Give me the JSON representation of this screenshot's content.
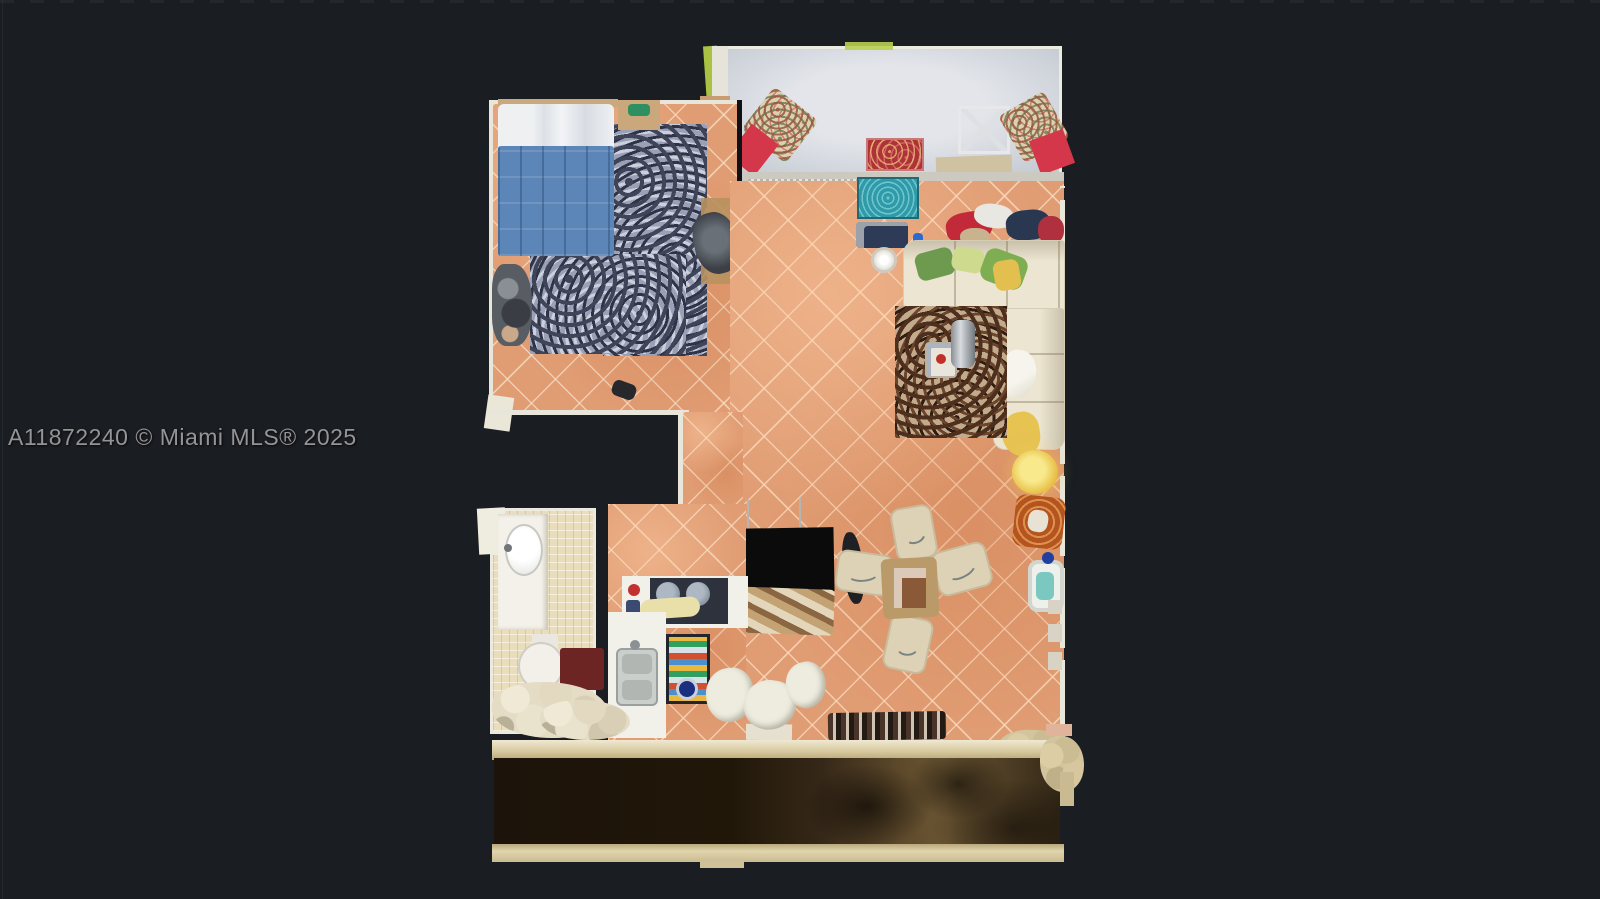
{
  "watermark": {
    "text": "A11872240 © Miami MLS® 2025"
  },
  "scene": {
    "kind": "top-down 3D dollhouse floor-plan scan of an apartment (MLS listing photo)",
    "background_color": "#1a1d22",
    "watermark_color": "#949494",
    "palette": {
      "tile_floor": "#e09c73",
      "bathroom_tile": "#e9ddbb",
      "terrace_floor": "#d9dce1",
      "walkway_floor": "#221809",
      "walls": "#e9e6da",
      "bed_duvet_blue": "#5d86b8",
      "sofa_cream": "#ece5d1",
      "accent_red": "#c22a3a",
      "teal_rug": "#2f9aa8",
      "maroon_mat": "#6c2522",
      "lamp_yellow": "#eccf56"
    },
    "rooms": [
      {
        "name": "terrace",
        "contents": [
          "red lounge chairs with floral cushions",
          "red patterned rug",
          "white metal table",
          "tan bench",
          "green planter accents"
        ]
      },
      {
        "name": "bedroom",
        "contents": [
          "bed with blue duvet and white pillows",
          "gray mottled shag rug",
          "nightstand",
          "desk with office chair",
          "chair with clothes"
        ]
      },
      {
        "name": "living-dining-room",
        "contents": [
          "cream L-shaped sectional sofa with green and yellow pillows",
          "brown shag rug with tray and bucket",
          "teal rug at sliding door",
          "pile of clothes",
          "round side table",
          "dining table with four cream chairs",
          "glowing floor lamp",
          "orange patterned armchair",
          "pet fountain",
          "black TV unit",
          "row of shoes"
        ]
      },
      {
        "name": "kitchen",
        "contents": [
          "cooktop counter with pots",
          "sink counter",
          "colorful kitchen mat",
          "white chairs"
        ]
      },
      {
        "name": "bathroom",
        "contents": [
          "vanity with oval sink",
          "toilet",
          "maroon bath mat",
          "shower area"
        ]
      },
      {
        "name": "rear-walkway",
        "contents": [
          "dark wood floor with shadows",
          "tan parapet walls"
        ]
      }
    ]
  }
}
